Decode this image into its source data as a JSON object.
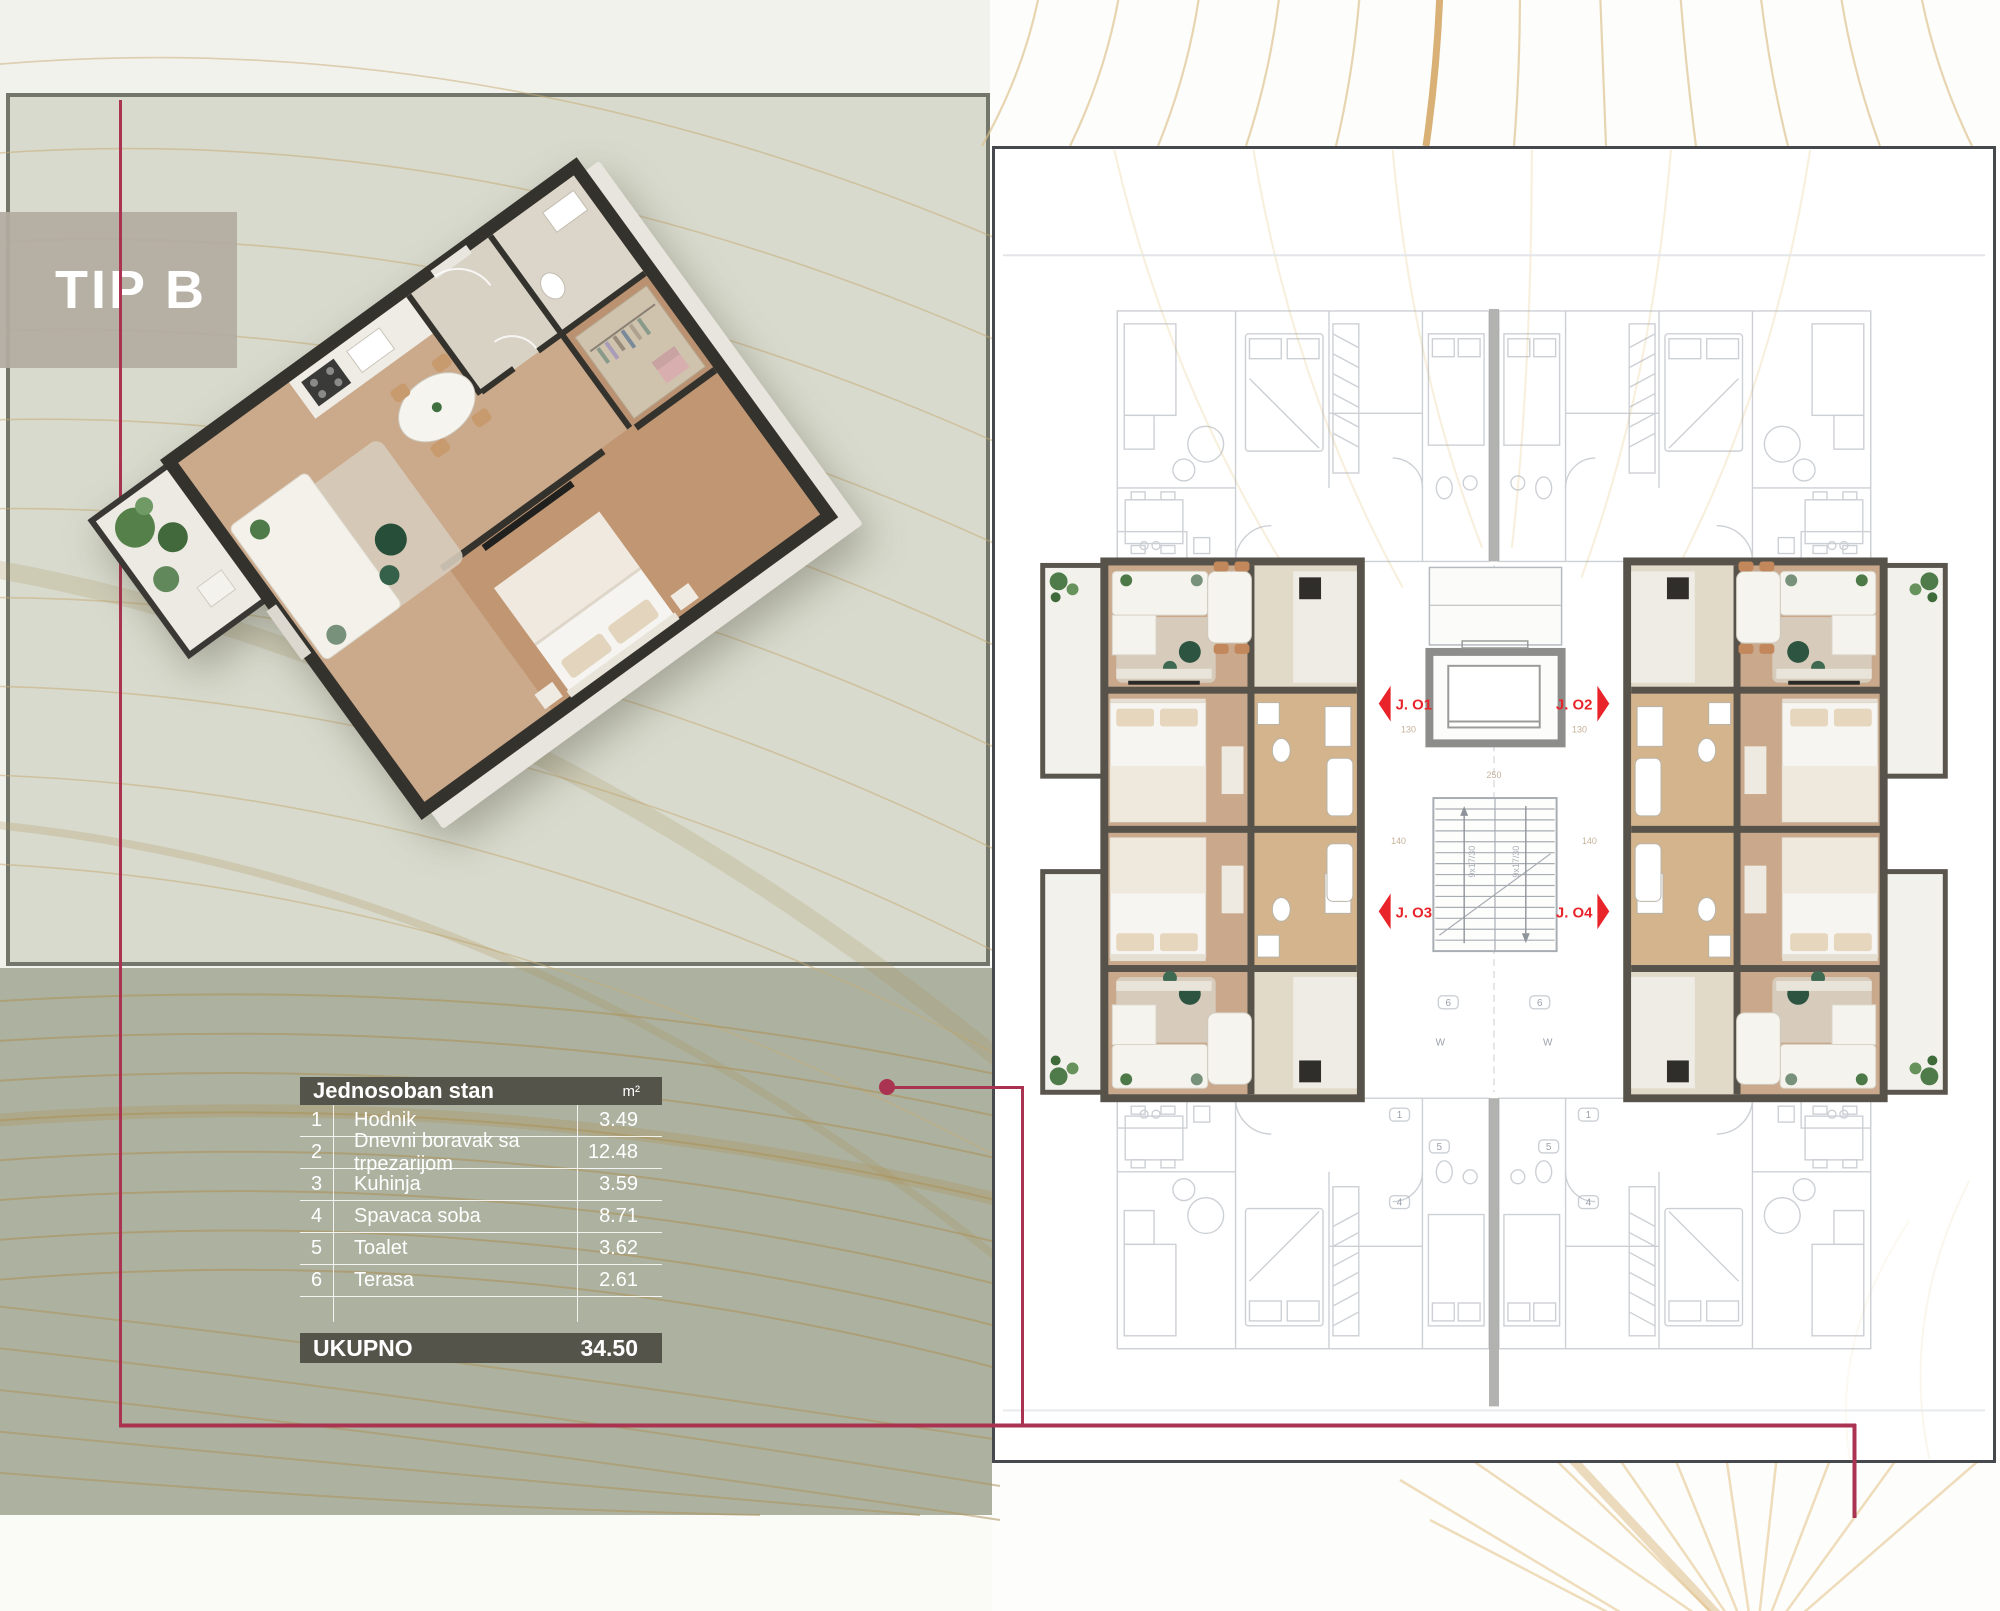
{
  "colors": {
    "accent": "#a93351",
    "sage": "#adb2a0",
    "panel": "#d8dacd",
    "panel-border": "#72766b",
    "cream": "#f2f2ec",
    "gold": "#c6aa72",
    "table-dark": "#55544b",
    "marker-red": "#e8242a"
  },
  "type_label": "TIP B",
  "table": {
    "title": "Jednosoban stan",
    "unit_header": "m²",
    "rows": [
      {
        "num": "1",
        "name": "Hodnik",
        "area": "3.49"
      },
      {
        "num": "2",
        "name": "Dnevni boravak sa trpezarijom",
        "area": "12.48"
      },
      {
        "num": "3",
        "name": "Kuhinja",
        "area": "3.59"
      },
      {
        "num": "4",
        "name": "Spavaca soba",
        "area": "8.71"
      },
      {
        "num": "5",
        "name": "Toalet",
        "area": "3.62"
      },
      {
        "num": "6",
        "name": "Terasa",
        "area": "2.61"
      }
    ],
    "total_label": "UKUPNO",
    "total_value": "34.50"
  },
  "floorplan": {
    "units": [
      {
        "label": "J. O1"
      },
      {
        "label": "J. O2"
      },
      {
        "label": "J. O3"
      },
      {
        "label": "J. O4"
      }
    ],
    "stair_label": "9x17/30",
    "dims": [
      "130",
      "130",
      "140",
      "140",
      "250"
    ],
    "badges": [
      "6",
      "6",
      "W",
      "W",
      "5",
      "5",
      "1",
      "1",
      "4",
      "4"
    ]
  }
}
